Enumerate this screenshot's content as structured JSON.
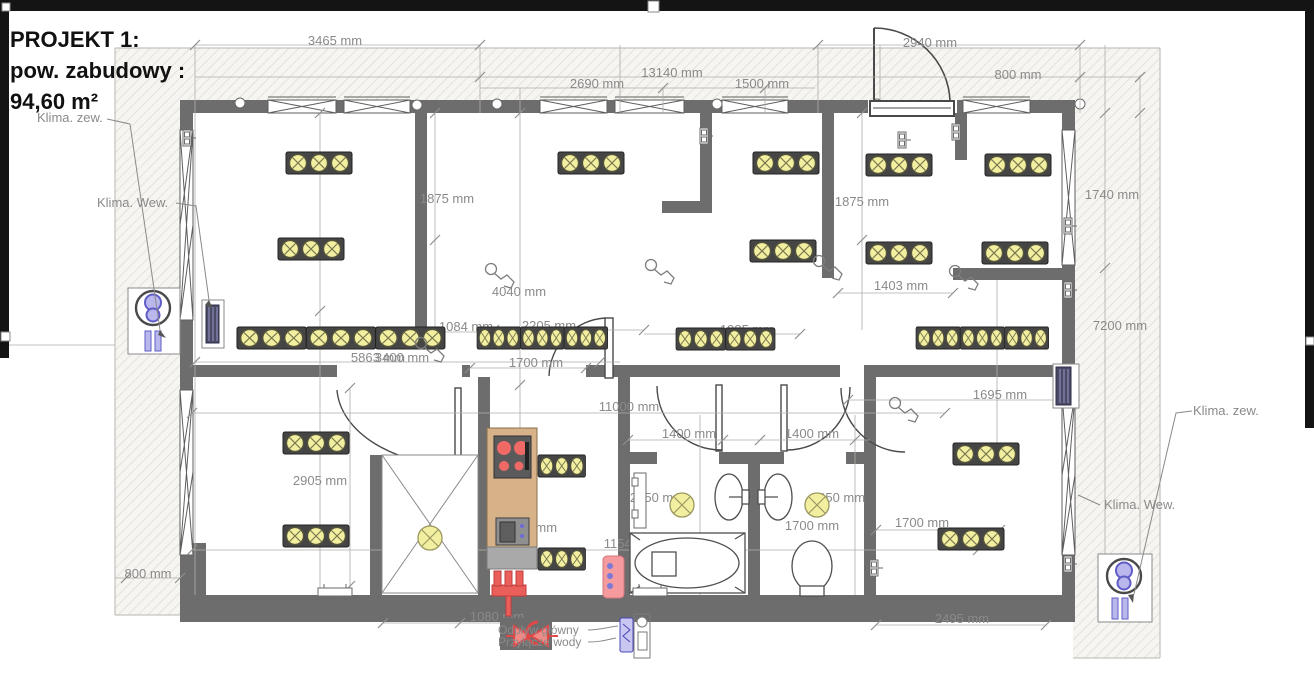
{
  "project": {
    "title_line1": "PROJEKT 1:",
    "title_line2": "pow. zabudowy :",
    "title_line3": "94,60 m²"
  },
  "labels": {
    "klima_zew_left": "Klima. zew.",
    "klima_wew_left": "Klima. Wew.",
    "klima_zew_right": "Klima. zew.",
    "klima_wew_right": "Klima. Wew.",
    "valve_line1": "Odpływ główny",
    "valve_line2": "Przyłącze wody"
  },
  "colors": {
    "wall_gray": "#6d6d6d",
    "dim_text_gray": "#8a8a8a",
    "light_yellow": "#f2efa1",
    "strip_dark": "#454545",
    "accent_red": "#ea5f5a",
    "tan_counter": "#d7b288",
    "hvac_purple": "#b9b7ec",
    "pink_panel": "#f59b9e",
    "hatch_line": "#d9d6cf"
  },
  "dimensions": [
    {
      "text": "3465 mm",
      "x": 335,
      "y": 45
    },
    {
      "text": "2940 mm",
      "x": 930,
      "y": 47
    },
    {
      "text": "13140 mm",
      "x": 672,
      "y": 77
    },
    {
      "text": "800 mm",
      "x": 1018,
      "y": 79
    },
    {
      "text": "2690 mm",
      "x": 597,
      "y": 88
    },
    {
      "text": "1500 mm",
      "x": 762,
      "y": 88
    },
    {
      "text": "1875 mm",
      "x": 447,
      "y": 203
    },
    {
      "text": "1875 mm",
      "x": 862,
      "y": 206
    },
    {
      "text": "1740 mm",
      "x": 1112,
      "y": 199
    },
    {
      "text": "2905 mm",
      "x": 316,
      "y": 247
    },
    {
      "text": "4040 mm",
      "x": 519,
      "y": 296
    },
    {
      "text": "1403 mm",
      "x": 901,
      "y": 290
    },
    {
      "text": "7200 mm",
      "x": 1120,
      "y": 330
    },
    {
      "text": "1084 mm",
      "x": 466,
      "y": 331
    },
    {
      "text": "2205 mm",
      "x": 549,
      "y": 330
    },
    {
      "text": "1985 mm",
      "x": 747,
      "y": 334
    },
    {
      "text": "5863 mm",
      "x": 378,
      "y": 362
    },
    {
      "text": "3400 mm",
      "x": 402,
      "y": 362
    },
    {
      "text": "1700 mm",
      "x": 536,
      "y": 367
    },
    {
      "text": "1695 mm",
      "x": 1000,
      "y": 399
    },
    {
      "text": "11000 mm",
      "x": 629,
      "y": 411
    },
    {
      "text": "1400 mm",
      "x": 689,
      "y": 438
    },
    {
      "text": "1400 mm",
      "x": 812,
      "y": 438
    },
    {
      "text": "2450 mm",
      "x": 657,
      "y": 502
    },
    {
      "text": "2450 mm",
      "x": 838,
      "y": 502
    },
    {
      "text": "2905 mm",
      "x": 320,
      "y": 485
    },
    {
      "text": "1828 mm",
      "x": 407,
      "y": 525
    },
    {
      "text": "1700 mm",
      "x": 530,
      "y": 532
    },
    {
      "text": "1700 mm",
      "x": 812,
      "y": 530
    },
    {
      "text": "1700 mm",
      "x": 922,
      "y": 527
    },
    {
      "text": "11540 mm",
      "x": 634,
      "y": 548
    },
    {
      "text": "800 mm",
      "x": 148,
      "y": 578
    },
    {
      "text": "1080 mm",
      "x": 497,
      "y": 621
    },
    {
      "text": "2495 mm",
      "x": 962,
      "y": 623
    }
  ]
}
